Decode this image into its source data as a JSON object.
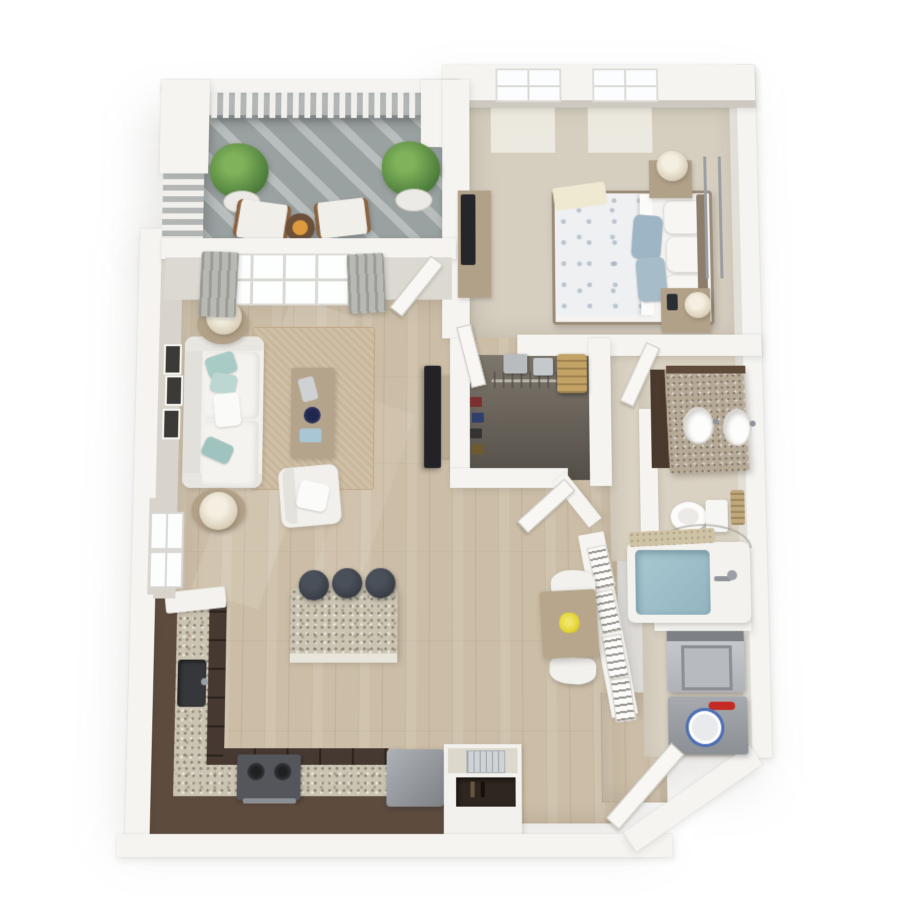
{
  "scene": {
    "kind": "3d-floor-plan-render",
    "view": "top-down isometric",
    "unit_type": "one-bedroom one-bath apartment",
    "visible_text": "",
    "background": "#ffffff"
  },
  "palette": {
    "wall": "#f5f4f1",
    "wallface": "#d8d4cc",
    "wood": "#cbbda6",
    "carpet": "#d6cfc0",
    "tile": "#d9d1c2",
    "balcony_floor": "#9aa1a1",
    "closet_floor_light": "#7d766c",
    "closet_floor_dark": "#544f48",
    "cabinet_brown": "#5d4b3e",
    "cabinet_front": "#463931",
    "granite": "#cbc4b2",
    "vanity_granite": "#b6aa97",
    "furniture_white": "#f1f0ec",
    "furniture_tan": "#b2a189",
    "pillow_teal": "#a9cbc6",
    "pillow_blue": "#9db5c4",
    "rug": "#c9b79c",
    "tub_water": "#a9c8d2",
    "plant_light": "#7fb25a",
    "plant_dark": "#3f6e33",
    "stool_dark": "#3b4047",
    "dryer_button_red": "#c42b24",
    "dryer_dial_blue": "#4d6eb5",
    "flower_yellow": "#e3d435"
  },
  "rooms": [
    {
      "name": "balcony",
      "floor": "gray concrete with railing shadows",
      "furniture": [
        "potted-plant",
        "potted-plant",
        "lounge-chair",
        "lounge-chair",
        "fire-table"
      ]
    },
    {
      "name": "bedroom",
      "floor": "beige carpet",
      "furniture": [
        "queen-bed",
        "nightstand",
        "nightstand",
        "table-lamp",
        "table-lamp",
        "dresser",
        "tv",
        "wall-rail"
      ],
      "windows": 2
    },
    {
      "name": "living-room",
      "floor": "light oak plank",
      "furniture": [
        "sofa",
        "side-table",
        "side-table",
        "table-lamp",
        "table-lamp",
        "coffee-table",
        "armchair",
        "area-rug",
        "tv",
        "tv-stand",
        "wall-frames"
      ],
      "windows": 2,
      "doors": [
        "patio-door"
      ]
    },
    {
      "name": "kitchen",
      "floor": "light oak plank",
      "furniture": [
        "l-shaped-counter",
        "sink",
        "range",
        "refrigerator",
        "island",
        "bar-stool",
        "bar-stool",
        "bar-stool",
        "built-in-cabinet"
      ]
    },
    {
      "name": "dining-nook",
      "furniture": [
        "dining-table",
        "dining-chair",
        "dining-chair",
        "flower-centerpiece"
      ]
    },
    {
      "name": "walk-in-closet",
      "floor": "dark charcoal",
      "furniture": [
        "hanging-rod",
        "storage-box",
        "storage-box",
        "bench",
        "shoe-row"
      ],
      "doors": [
        "closet-door"
      ]
    },
    {
      "name": "bathroom",
      "floor": "beige tile",
      "furniture": [
        "double-sink-vanity",
        "toilet",
        "towel-basket",
        "bathtub",
        "bath-mat",
        "shower-rod"
      ],
      "doors": [
        "bathroom-door"
      ]
    },
    {
      "name": "laundry-closet",
      "furniture": [
        "washer",
        "dryer"
      ],
      "doors": [
        "louvered-door-panels"
      ]
    },
    {
      "name": "entry",
      "doors": [
        "entry-door"
      ],
      "feature": "angled corner wall"
    }
  ],
  "counts": {
    "bar_stools": 3,
    "balcony_plants": 2,
    "bedroom_windows": 2,
    "wall_frames": 3,
    "louver_panels": 4,
    "bed_white_pillows": 3,
    "bed_blue_pillows": 2
  }
}
